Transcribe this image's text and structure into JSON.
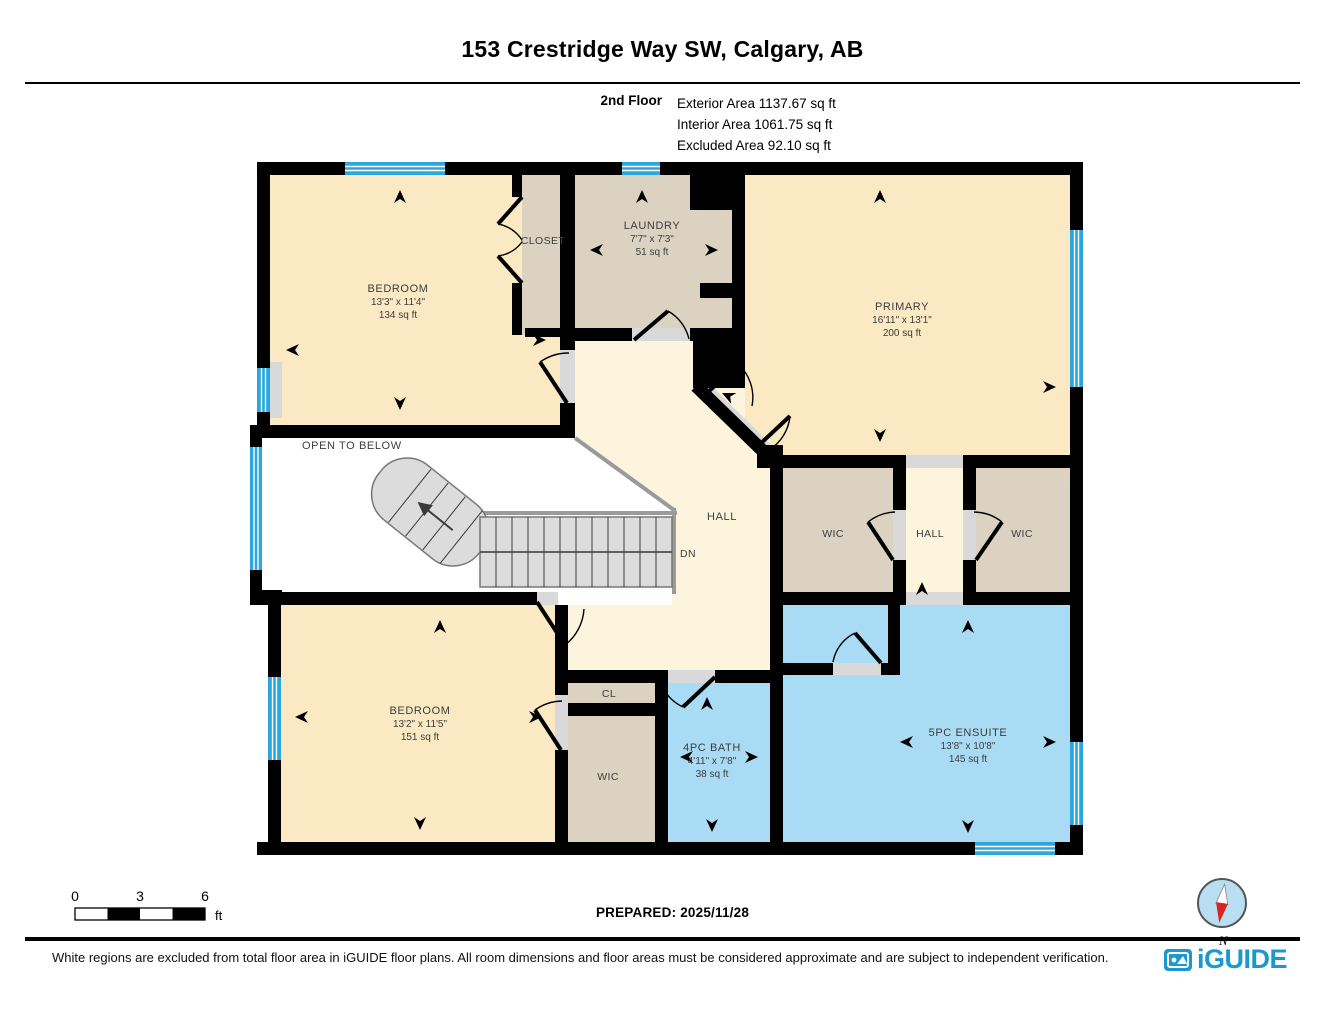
{
  "header": {
    "title": "153 Crestridge Way SW, Calgary, AB",
    "floor_label": "2nd Floor",
    "area_line_1": "Exterior Area 1137.67 sq ft",
    "area_line_2": "Interior Area 1061.75 sq ft",
    "area_line_3": "Excluded Area 92.10 sq ft"
  },
  "rooms": {
    "bedroom_tl": {
      "name": "BEDROOM",
      "dims": "13'3\" x 11'4\"",
      "area": "134 sq ft"
    },
    "closet": {
      "name": "CLOSET"
    },
    "laundry": {
      "name": "LAUNDRY",
      "dims": "7'7\" x 7'3\"",
      "area": "51 sq ft"
    },
    "primary": {
      "name": "PRIMARY",
      "dims": "16'11\" x 13'1\"",
      "area": "200 sq ft"
    },
    "open_to_below": {
      "name": "OPEN TO BELOW"
    },
    "hall_main": {
      "name": "HALL"
    },
    "stairs": {
      "down_label": "DN"
    },
    "wic_left": {
      "name": "WIC"
    },
    "hall_small": {
      "name": "HALL"
    },
    "wic_right": {
      "name": "WIC"
    },
    "bedroom_bl": {
      "name": "BEDROOM",
      "dims": "13'2\" x 11'5\"",
      "area": "151 sq ft"
    },
    "cl": {
      "name": "CL"
    },
    "wic_bottom": {
      "name": "WIC"
    },
    "bath": {
      "name": "4PC BATH",
      "dims": "4'11\" x 7'8\"",
      "area": "38 sq ft"
    },
    "ensuite": {
      "name": "5PC ENSUITE",
      "dims": "13'8\" x 10'8\"",
      "area": "145 sq ft"
    }
  },
  "scale_bar": {
    "tick_0": "0",
    "tick_3": "3",
    "tick_6": "6",
    "unit": "ft"
  },
  "prepared_label": "PREPARED: 2025/11/28",
  "compass": {
    "north_label": "N"
  },
  "footer": {
    "disclaimer": "White regions are excluded from total floor area in iGUIDE floor plans. All room dimensions and floor areas must be considered approximate and are subject to independent verification.",
    "brand": "iGUIDE"
  },
  "colors": {
    "room_cream": "#FAE9C3",
    "hall_cream": "#FCF4DC",
    "room_beige": "#DBD2C1",
    "room_blue": "#A9DBF5",
    "window_blue": "#2AA7DE",
    "wall_black": "#000000",
    "stair_gray": "#DCDCDC",
    "logo_blue": "#1B99CE"
  }
}
